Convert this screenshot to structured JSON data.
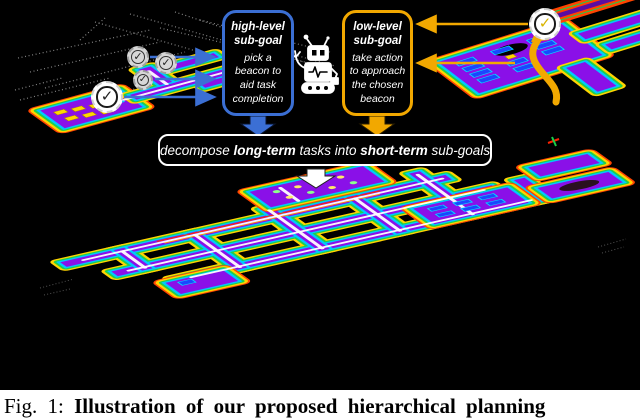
{
  "figure": {
    "check_glyph": "✓",
    "high_level_box": {
      "title": "high-level sub-goal",
      "body": "pick a beacon to aid task completion"
    },
    "low_level_box": {
      "title": "low-level sub-goal",
      "body": "take action to approach the chosen beacon"
    },
    "banner": {
      "segments": [
        {
          "text": "decompose ",
          "bold": false
        },
        {
          "text": "long-term",
          "bold": true
        },
        {
          "text": " tasks into ",
          "bold": false
        },
        {
          "text": "short-term",
          "bold": true
        },
        {
          "text": " sub-goals",
          "bold": false
        }
      ]
    },
    "icons": {
      "robot": "robot-icon",
      "beacon_badge": "check-badge",
      "goal_badge": "goal-check-badge"
    }
  },
  "caption": {
    "label": "Fig. 1:",
    "text": "Illustration of our proposed hierarchical planning"
  },
  "colors": {
    "accent-blue": "#3b6fd4",
    "accent-orange": "#f2a800",
    "floor-purple": "#8a10e8",
    "wall-red": "#ff4400",
    "wall-yellow": "#ffd400",
    "wall-green": "#1ed04a",
    "wall-cyan": "#00c8ff",
    "path-white": "#ffffff",
    "desk-blue": "#1a46ff",
    "desk-cyan": "#00e0ff",
    "object-yellow": "#ffd700",
    "pointcloud-gray": "#9b9b9b",
    "badge-check-dark": "#222222",
    "badge-check-yellow": "#d8b400"
  }
}
